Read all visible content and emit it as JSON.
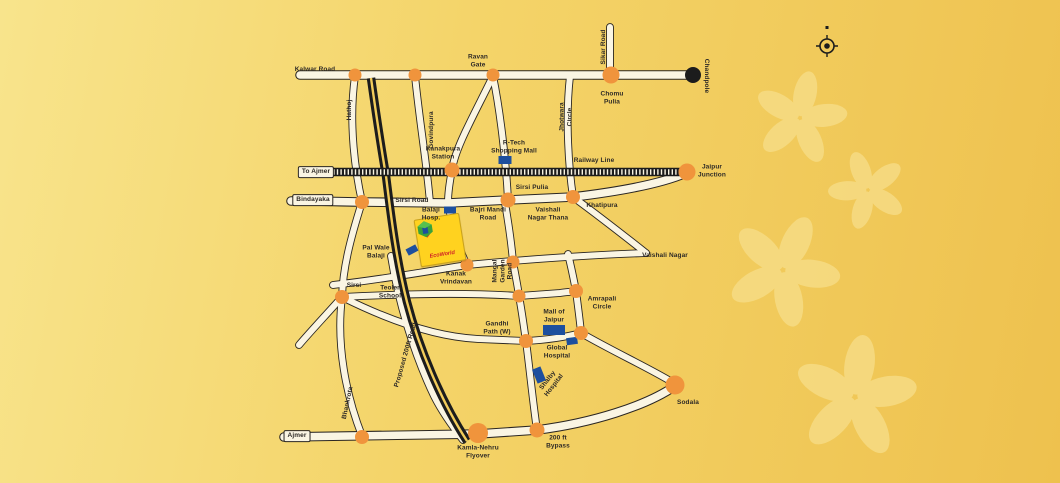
{
  "colors": {
    "bg_left": "#f8e48c",
    "bg_right": "#eec14e",
    "road": "#faf5e3",
    "road_outline": "#2a2622",
    "junction_orange": "#f0943c",
    "landmark_blue": "#1d4f9e",
    "rail_black": "#1c1c1c",
    "flower": "#f7dd87",
    "label_ink": "#2e2a26",
    "logo_yellow": "#ffd21f",
    "logo_red": "#d01f26"
  },
  "map": {
    "logo": {
      "text": "EcoWorld"
    },
    "labels": [
      {
        "id": "kalwar-road",
        "text": "Kalwar Road",
        "x": 315,
        "y": 70
      },
      {
        "id": "ravan-gate",
        "text": "Ravan\nGate",
        "x": 478,
        "y": 61
      },
      {
        "id": "sikar-road",
        "text": "Sikar Road",
        "x": 604,
        "y": 47,
        "rot": -90
      },
      {
        "id": "chandpole",
        "text": "Chandpole",
        "x": 706,
        "y": 76,
        "rot": 90
      },
      {
        "id": "chomu-pulia",
        "text": "Chomu\nPulia",
        "x": 612,
        "y": 98
      },
      {
        "id": "jhotwara-circle",
        "text": "Jhotwara\nCircle",
        "x": 566,
        "y": 117,
        "rot": -90
      },
      {
        "id": "hathoj",
        "text": "Hathoj",
        "x": 350,
        "y": 110,
        "rot": -90
      },
      {
        "id": "govindpura",
        "text": "Govindpura",
        "x": 432,
        "y": 130,
        "rot": -90
      },
      {
        "id": "kanakpura-station",
        "text": "Kanakpura\nStation",
        "x": 443,
        "y": 153
      },
      {
        "id": "rtech-shopping-mall",
        "text": "R-Tech\nShopping Mall",
        "x": 514,
        "y": 147
      },
      {
        "id": "railway-line",
        "text": "Railway Line",
        "x": 594,
        "y": 161
      },
      {
        "id": "jaipur-junction",
        "text": "Jaipur\nJunction",
        "x": 712,
        "y": 171
      },
      {
        "id": "sirsi-pulia",
        "text": "Sirsi Pulia",
        "x": 532,
        "y": 188
      },
      {
        "id": "sirsi-road",
        "text": "Sirsi Road",
        "x": 412,
        "y": 201
      },
      {
        "id": "vaishali-nagar-thana",
        "text": "Vaishali\nNagar Thana",
        "x": 548,
        "y": 214
      },
      {
        "id": "khatipura",
        "text": "Khatipura",
        "x": 602,
        "y": 206
      },
      {
        "id": "balaji-hosp",
        "text": "Balaji\nHosp.",
        "x": 431,
        "y": 214
      },
      {
        "id": "bajri-mandi-road",
        "text": "Bajri Mandi\nRoad",
        "x": 488,
        "y": 214
      },
      {
        "id": "pal-wale-balaji",
        "text": "Pal Wale\nBalaji",
        "x": 376,
        "y": 252
      },
      {
        "id": "kanak-vrindavan",
        "text": "Kanak\nVrindavan",
        "x": 456,
        "y": 278
      },
      {
        "id": "mangal-garden-road",
        "text": "Mangal\nGarden\nRoad",
        "x": 503,
        "y": 271,
        "rot": -90
      },
      {
        "id": "vaishali-nagar",
        "text": "Vaishali Nagar",
        "x": 665,
        "y": 256
      },
      {
        "id": "sirsi",
        "text": "Sirsi",
        "x": 354,
        "y": 286
      },
      {
        "id": "teoler-school",
        "text": "Teoler\nSchool",
        "x": 390,
        "y": 292
      },
      {
        "id": "amrapali-circle",
        "text": "Amrapali\nCircle",
        "x": 602,
        "y": 303
      },
      {
        "id": "gandhi-path-w",
        "text": "Gandhi\nPath (W)",
        "x": 497,
        "y": 328
      },
      {
        "id": "mall-of-jaipur",
        "text": "Mall of\nJaipur",
        "x": 554,
        "y": 316
      },
      {
        "id": "global-hospital",
        "text": "Global\nHospital",
        "x": 557,
        "y": 352
      },
      {
        "id": "shalby-hospital",
        "text": "Shalby\nHospital",
        "x": 551,
        "y": 383,
        "rot": -52
      },
      {
        "id": "proposed-200ft-road",
        "text": "Proposed 200ft Road",
        "x": 406,
        "y": 355,
        "rot": -74
      },
      {
        "id": "bhankrota",
        "text": "Bhankrota",
        "x": 348,
        "y": 403,
        "rot": -78
      },
      {
        "id": "kamla-nehru-flyover",
        "text": "Kamla-Nehru\nFlyover",
        "x": 478,
        "y": 452
      },
      {
        "id": "bypass-200ft",
        "text": "200 ft\nBypass",
        "x": 558,
        "y": 442
      },
      {
        "id": "sodala",
        "text": "Sodala",
        "x": 688,
        "y": 403
      },
      {
        "id": "to-ajmer",
        "text": "To Ajmer",
        "x": 316,
        "y": 172,
        "box": true
      },
      {
        "id": "bindayaka",
        "text": "Bindayaka",
        "x": 313,
        "y": 200,
        "box": true
      },
      {
        "id": "ajmer",
        "text": "Ajmer",
        "x": 297,
        "y": 436,
        "box": true
      }
    ],
    "junctions": [
      {
        "id": "kalwar-hathoj",
        "x": 355,
        "y": 75,
        "r": 6.5
      },
      {
        "id": "kalwar-govindpura",
        "x": 415,
        "y": 75,
        "r": 6.5
      },
      {
        "id": "ravan-gate",
        "x": 493,
        "y": 75,
        "r": 6.5
      },
      {
        "id": "chomu-pulia",
        "x": 611,
        "y": 75,
        "r": 8.5
      },
      {
        "id": "chandpole",
        "x": 693,
        "y": 75,
        "r": 8,
        "color": "black"
      },
      {
        "id": "kanakpura-station",
        "x": 452,
        "y": 170,
        "r": 7.5
      },
      {
        "id": "jaipur-junction",
        "x": 687,
        "y": 172,
        "r": 8.5
      },
      {
        "id": "sirsi-west",
        "x": 362,
        "y": 202,
        "r": 7
      },
      {
        "id": "sirsi-pulia",
        "x": 508,
        "y": 200,
        "r": 7.5
      },
      {
        "id": "khatipura",
        "x": 573,
        "y": 197,
        "r": 7
      },
      {
        "id": "kanak-vrindavan",
        "x": 467,
        "y": 265,
        "r": 6.5
      },
      {
        "id": "mangal-garden-upper",
        "x": 513,
        "y": 262,
        "r": 6.5
      },
      {
        "id": "mangal-garden-mid",
        "x": 519,
        "y": 296,
        "r": 6.5
      },
      {
        "id": "gandhi-path",
        "x": 526,
        "y": 341,
        "r": 7
      },
      {
        "id": "bypass-200ft",
        "x": 537,
        "y": 430,
        "r": 7.5
      },
      {
        "id": "sirsi",
        "x": 342,
        "y": 297,
        "r": 7
      },
      {
        "id": "amrapali-circle",
        "x": 576,
        "y": 291,
        "r": 7
      },
      {
        "id": "gandhi-east",
        "x": 581,
        "y": 333,
        "r": 7
      },
      {
        "id": "bhankrota",
        "x": 362,
        "y": 437,
        "r": 7
      },
      {
        "id": "kamla-nehru-flyover",
        "x": 478,
        "y": 433,
        "r": 10
      },
      {
        "id": "sodala",
        "x": 675,
        "y": 385,
        "r": 9.5
      }
    ],
    "landmarks": [
      {
        "id": "rtech-shopping-mall",
        "x": 505,
        "y": 160,
        "w": 13,
        "h": 8,
        "rot": 0
      },
      {
        "id": "balaji-hosp",
        "x": 450,
        "y": 210,
        "w": 12,
        "h": 7,
        "rot": 0
      },
      {
        "id": "pal-wale-balaji",
        "x": 412,
        "y": 250,
        "w": 11,
        "h": 7,
        "rot": -28
      },
      {
        "id": "mall-of-jaipur",
        "x": 554,
        "y": 330,
        "w": 22,
        "h": 10,
        "rot": 0
      },
      {
        "id": "global-hospital",
        "x": 572,
        "y": 341,
        "w": 11,
        "h": 7,
        "rot": -8
      },
      {
        "id": "shalby-hospital",
        "x": 539,
        "y": 375,
        "w": 9,
        "h": 15,
        "rot": -22
      }
    ]
  }
}
